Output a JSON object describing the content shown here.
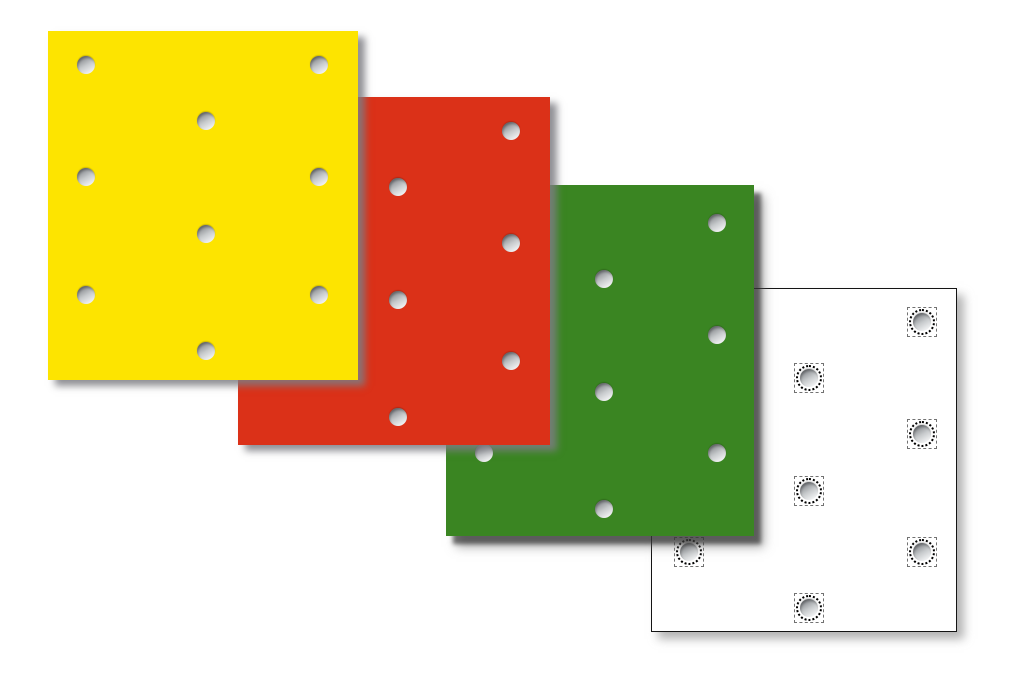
{
  "canvas": {
    "width": 1018,
    "height": 683,
    "background": "#ffffff"
  },
  "plates": [
    {
      "name": "white",
      "color": "#ffffff",
      "x": 651,
      "y": 288,
      "width": 306,
      "height": 344,
      "z": 1,
      "border": "#141414",
      "speckled_holes": true,
      "hole_offset": [
        0,
        0
      ]
    },
    {
      "name": "green",
      "color": "#3a8522",
      "x": 446,
      "y": 185,
      "width": 308,
      "height": 351,
      "z": 2,
      "border": null,
      "speckled_holes": false,
      "hole_offset": [
        0,
        4
      ]
    },
    {
      "name": "red",
      "color": "#db3118",
      "x": 238,
      "y": 97,
      "width": 312,
      "height": 348,
      "z": 3,
      "border": null,
      "speckled_holes": false,
      "hole_offset": [
        2,
        0
      ]
    },
    {
      "name": "yellow",
      "color": "#fde400",
      "x": 48,
      "y": 31,
      "width": 310,
      "height": 349,
      "z": 4,
      "border": null,
      "speckled_holes": false,
      "hole_offset": [
        0,
        0
      ]
    }
  ],
  "hole_pattern_rel_centers": [
    [
      38,
      34
    ],
    [
      271,
      34
    ],
    [
      158,
      90
    ],
    [
      38,
      146
    ],
    [
      271,
      146
    ],
    [
      158,
      203
    ],
    [
      38,
      264
    ],
    [
      271,
      264
    ],
    [
      158,
      320
    ]
  ],
  "hole_style": {
    "diameter": 18,
    "gradient_dark": "#8c8f93",
    "gradient_mid": "#c7cacc",
    "gradient_light": "#f3f4f5",
    "speckle_color": "#000000"
  }
}
